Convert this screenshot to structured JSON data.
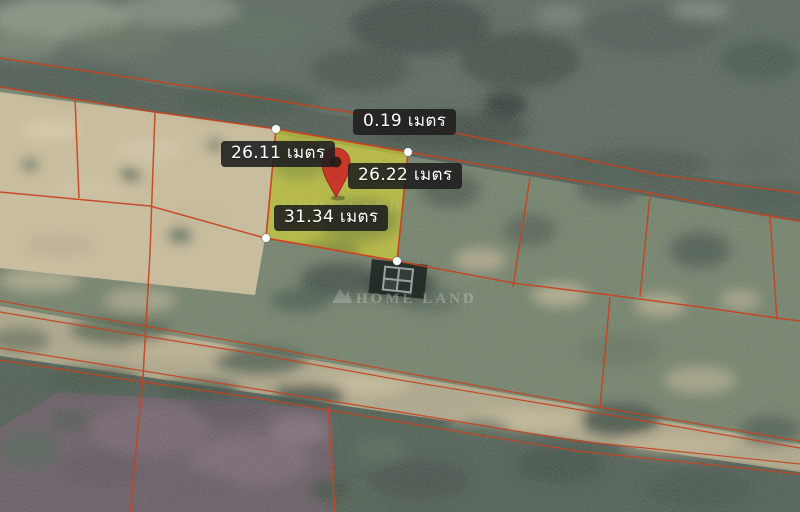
{
  "map": {
    "view": "satellite-cadastral-plot",
    "watermark": {
      "brand": "HOME LAND",
      "brand_repeat": "HOME LAND"
    },
    "colors": {
      "boundary_line": "#c7421f",
      "parcel_fill": "#e8e22c",
      "parcel_outline": "#cc4422",
      "pin": "#c9372b",
      "vertex_dot": "#ffffff",
      "label_bg": "#212121",
      "label_text": "#ffffff"
    },
    "parcel": {
      "vertex_count": 4
    },
    "measurements": [
      {
        "position": "top",
        "value": 0.19,
        "unit": "เมตร",
        "label": "0.19 เมตร"
      },
      {
        "position": "left",
        "value": 26.11,
        "unit": "เมตร",
        "label": "26.11 เมตร"
      },
      {
        "position": "right",
        "value": 26.22,
        "unit": "เมตร",
        "label": "26.22 เมตร"
      },
      {
        "position": "bottom",
        "value": 31.34,
        "unit": "เมตร",
        "label": "31.34 เมตร"
      }
    ]
  }
}
